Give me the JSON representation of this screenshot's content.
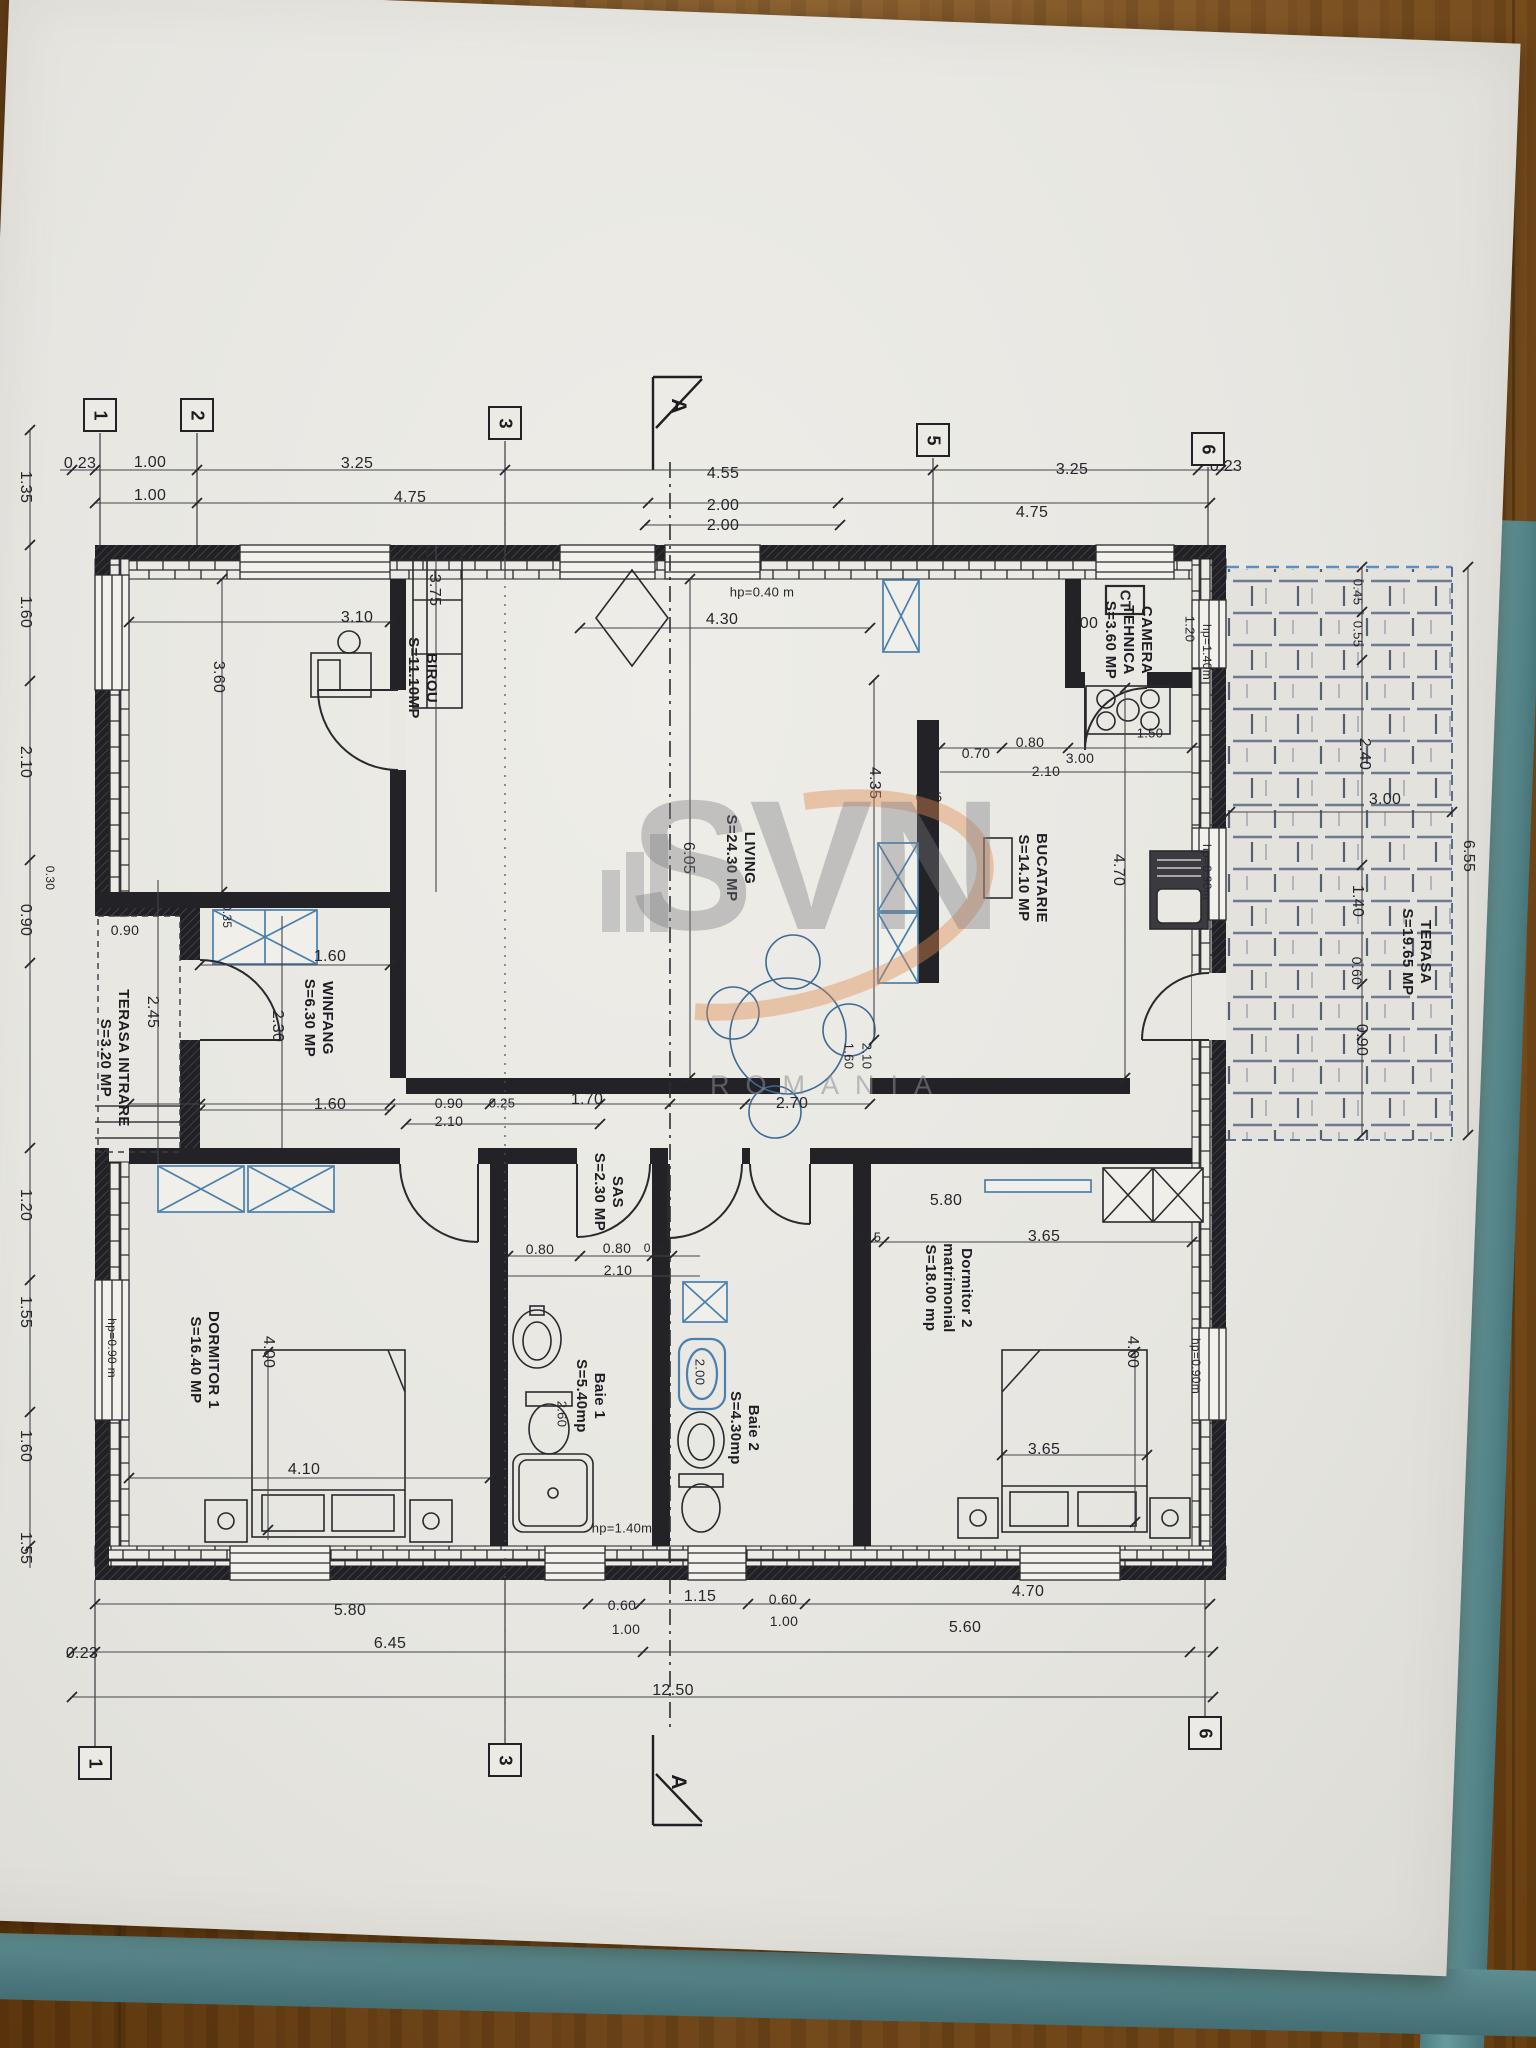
{
  "watermark": {
    "brand": "SVN",
    "sub": "ROMANIA"
  },
  "colors": {
    "ink": "#26262b",
    "paper": "#e9e8e3",
    "wood": "#a8803f",
    "folder": "#5e8d91",
    "window_blue": "#4a7fae",
    "tile": "#74809a",
    "watermark_orange": "#e08a50",
    "watermark_grey": "#8c8c92"
  },
  "plan": {
    "room_labels": [
      {
        "lines": [
          "BIROU",
          "S=11.10MP"
        ],
        "x": 422,
        "y": 678
      },
      {
        "lines": [
          "LIVING",
          "S=24.30 MP"
        ],
        "x": 740,
        "y": 858
      },
      {
        "lines": [
          "CAMERA",
          "TEHNICA",
          "S=3.60 MP"
        ],
        "x": 1128,
        "y": 640
      },
      {
        "lines": [
          "BUCATARIE",
          "S=14.10 MP"
        ],
        "x": 1032,
        "y": 878
      },
      {
        "lines": [
          "WINFANG",
          "S=6.30 MP"
        ],
        "x": 318,
        "y": 1018
      },
      {
        "lines": [
          "SAS",
          "S=2.30 MP"
        ],
        "x": 608,
        "y": 1192
      },
      {
        "lines": [
          "TERASA INTRARE",
          "S=3.20 MP"
        ],
        "x": 114,
        "y": 1058
      },
      {
        "lines": [
          "TERASA",
          "S=19.65 MP"
        ],
        "x": 1416,
        "y": 952
      },
      {
        "lines": [
          "DORMITOR 1",
          "S=16.40 MP"
        ],
        "x": 204,
        "y": 1360
      },
      {
        "lines": [
          "Dormitor 2",
          "matrimonial",
          "S=18.00 mp"
        ],
        "x": 948,
        "y": 1288
      },
      {
        "lines": [
          "Baie 1",
          "S=5.40mp"
        ],
        "x": 590,
        "y": 1396
      },
      {
        "lines": [
          "Baie 2",
          "S=4.30mp"
        ],
        "x": 744,
        "y": 1428
      }
    ],
    "dim_labels": [
      {
        "t": "0.23",
        "x": 80,
        "y": 464
      },
      {
        "t": "1.00",
        "x": 150,
        "y": 463
      },
      {
        "t": "3.25",
        "x": 357,
        "y": 464
      },
      {
        "t": "4.55",
        "x": 723,
        "y": 474
      },
      {
        "t": "3.25",
        "x": 1072,
        "y": 470
      },
      {
        "t": "0.23",
        "x": 1226,
        "y": 467
      },
      {
        "t": "1.00",
        "x": 150,
        "y": 496
      },
      {
        "t": "4.75",
        "x": 410,
        "y": 498
      },
      {
        "t": "2.00",
        "x": 723,
        "y": 506
      },
      {
        "t": "4.75",
        "x": 1032,
        "y": 513
      },
      {
        "t": "2.00",
        "x": 723,
        "y": 526
      },
      {
        "t": "hp=0.40 m",
        "x": 762,
        "y": 592,
        "f": 13
      },
      {
        "t": "3.10",
        "x": 357,
        "y": 618
      },
      {
        "t": "4.30",
        "x": 722,
        "y": 620
      },
      {
        "t": "3.00",
        "x": 1082,
        "y": 624
      },
      {
        "t": "3.60",
        "x": 218,
        "y": 677,
        "r": 90
      },
      {
        "t": "3.75",
        "x": 434,
        "y": 590,
        "r": 90
      },
      {
        "t": "6.05",
        "x": 688,
        "y": 858,
        "r": 90
      },
      {
        "t": "4.35",
        "x": 874,
        "y": 783,
        "r": 90
      },
      {
        "t": "4.70",
        "x": 1118,
        "y": 870,
        "r": 90
      },
      {
        "t": "0.70",
        "x": 976,
        "y": 753,
        "f": 14
      },
      {
        "t": "0.80",
        "x": 1030,
        "y": 742,
        "f": 14
      },
      {
        "t": "2.10",
        "x": 1046,
        "y": 771,
        "f": 14
      },
      {
        "t": "3.00",
        "x": 1080,
        "y": 758,
        "f": 14
      },
      {
        "t": "1.50",
        "x": 1150,
        "y": 733,
        "f": 13
      },
      {
        "t": "0.25",
        "x": 929,
        "y": 797,
        "f": 13
      },
      {
        "t": "1.20",
        "x": 1190,
        "y": 629,
        "r": 90,
        "f": 13
      },
      {
        "t": "hp=1.40m",
        "x": 1207,
        "y": 652,
        "r": 90,
        "f": 12
      },
      {
        "t": "hp=0.90m",
        "x": 1207,
        "y": 872,
        "r": 90,
        "f": 12
      },
      {
        "t": "0.90",
        "x": 125,
        "y": 930,
        "f": 14
      },
      {
        "t": "0.35",
        "x": 227,
        "y": 916,
        "r": 90,
        "f": 12
      },
      {
        "t": "1.60",
        "x": 330,
        "y": 957
      },
      {
        "t": "2.45",
        "x": 152,
        "y": 1012,
        "r": 90
      },
      {
        "t": "2.30",
        "x": 277,
        "y": 1026,
        "r": 90
      },
      {
        "t": "1.60",
        "x": 330,
        "y": 1105
      },
      {
        "t": "0.90",
        "x": 449,
        "y": 1103,
        "f": 14
      },
      {
        "t": "0.25",
        "x": 502,
        "y": 1103,
        "f": 13
      },
      {
        "t": "1.70",
        "x": 587,
        "y": 1100
      },
      {
        "t": "2.10",
        "x": 449,
        "y": 1121,
        "f": 14
      },
      {
        "t": "2.70",
        "x": 792,
        "y": 1104
      },
      {
        "t": "1.60",
        "x": 849,
        "y": 1056,
        "r": 90,
        "f": 13
      },
      {
        "t": "2.10",
        "x": 867,
        "y": 1056,
        "r": 90,
        "f": 13
      },
      {
        "t": "5.80",
        "x": 946,
        "y": 1201
      },
      {
        "t": "0.15",
        "x": 868,
        "y": 1237,
        "f": 13
      },
      {
        "t": "3.65",
        "x": 1044,
        "y": 1237
      },
      {
        "t": "0.80",
        "x": 540,
        "y": 1249,
        "f": 14
      },
      {
        "t": "0.80",
        "x": 617,
        "y": 1248,
        "f": 14
      },
      {
        "t": "0.10",
        "x": 656,
        "y": 1248,
        "f": 12
      },
      {
        "t": "2.10",
        "x": 618,
        "y": 1270,
        "f": 14
      },
      {
        "t": "2.60",
        "x": 562,
        "y": 1414,
        "r": 90,
        "f": 13
      },
      {
        "t": "2.00",
        "x": 700,
        "y": 1372,
        "r": 90,
        "f": 13
      },
      {
        "t": "hp=1.40m",
        "x": 622,
        "y": 1528,
        "f": 13
      },
      {
        "t": "hp=0.90 m",
        "x": 112,
        "y": 1348,
        "r": 90,
        "f": 12
      },
      {
        "t": "4.00",
        "x": 268,
        "y": 1352,
        "r": 90
      },
      {
        "t": "4.10",
        "x": 304,
        "y": 1470
      },
      {
        "t": "4.00",
        "x": 1132,
        "y": 1352,
        "r": 90
      },
      {
        "t": "3.65",
        "x": 1044,
        "y": 1450
      },
      {
        "t": "hp=0.90m",
        "x": 1196,
        "y": 1366,
        "r": 90,
        "f": 12
      },
      {
        "t": "0.45",
        "x": 1358,
        "y": 592,
        "r": 90,
        "f": 13
      },
      {
        "t": "0.55",
        "x": 1358,
        "y": 634,
        "r": 90,
        "f": 13
      },
      {
        "t": "2.40",
        "x": 1364,
        "y": 754,
        "r": 90
      },
      {
        "t": "1.40",
        "x": 1357,
        "y": 901,
        "r": 90
      },
      {
        "t": "0.60",
        "x": 1357,
        "y": 971,
        "r": 90,
        "f": 14
      },
      {
        "t": "0.90",
        "x": 1361,
        "y": 1040,
        "r": 90
      },
      {
        "t": "6.55",
        "x": 1468,
        "y": 856,
        "r": 90
      },
      {
        "t": "3.00",
        "x": 1385,
        "y": 800
      },
      {
        "t": "5.80",
        "x": 350,
        "y": 1611
      },
      {
        "t": "0.60",
        "x": 622,
        "y": 1605,
        "f": 14
      },
      {
        "t": "1.00",
        "x": 626,
        "y": 1629,
        "f": 14
      },
      {
        "t": "1.15",
        "x": 700,
        "y": 1597
      },
      {
        "t": "0.60",
        "x": 783,
        "y": 1599,
        "f": 14
      },
      {
        "t": "1.00",
        "x": 784,
        "y": 1621,
        "f": 14
      },
      {
        "t": "4.70",
        "x": 1028,
        "y": 1592
      },
      {
        "t": "0.23",
        "x": 82,
        "y": 1654
      },
      {
        "t": "6.45",
        "x": 390,
        "y": 1644
      },
      {
        "t": "5.60",
        "x": 965,
        "y": 1628
      },
      {
        "t": "12.50",
        "x": 673,
        "y": 1691
      },
      {
        "t": "1.35",
        "x": 25,
        "y": 487,
        "r": 90
      },
      {
        "t": "1.60",
        "x": 25,
        "y": 612,
        "r": 90
      },
      {
        "t": "2.10",
        "x": 25,
        "y": 762,
        "r": 90
      },
      {
        "t": "0.30",
        "x": 50,
        "y": 878,
        "r": 90,
        "f": 12
      },
      {
        "t": "0.90",
        "x": 25,
        "y": 920,
        "r": 90
      },
      {
        "t": "1.20",
        "x": 25,
        "y": 1205,
        "r": 90
      },
      {
        "t": "1.55",
        "x": 25,
        "y": 1312,
        "r": 90
      },
      {
        "t": "1.60",
        "x": 25,
        "y": 1446,
        "r": 90
      },
      {
        "t": "1.55",
        "x": 25,
        "y": 1548,
        "r": 90
      },
      {
        "t": "CT",
        "x": 1125,
        "y": 600,
        "r": 90,
        "f": 15,
        "b": 1
      }
    ],
    "grid_bubbles": [
      {
        "n": "1",
        "x": 100,
        "y": 415
      },
      {
        "n": "2",
        "x": 197,
        "y": 415
      },
      {
        "n": "3",
        "x": 505,
        "y": 423
      },
      {
        "n": "5",
        "x": 933,
        "y": 440
      },
      {
        "n": "6",
        "x": 1208,
        "y": 449
      },
      {
        "n": "1",
        "x": 95,
        "y": 1763
      },
      {
        "n": "3",
        "x": 505,
        "y": 1760
      },
      {
        "n": "6",
        "x": 1205,
        "y": 1733
      }
    ],
    "section_labels": [
      {
        "t": "A",
        "x": 678,
        "y": 406
      },
      {
        "t": "A",
        "x": 678,
        "y": 1782
      }
    ]
  }
}
